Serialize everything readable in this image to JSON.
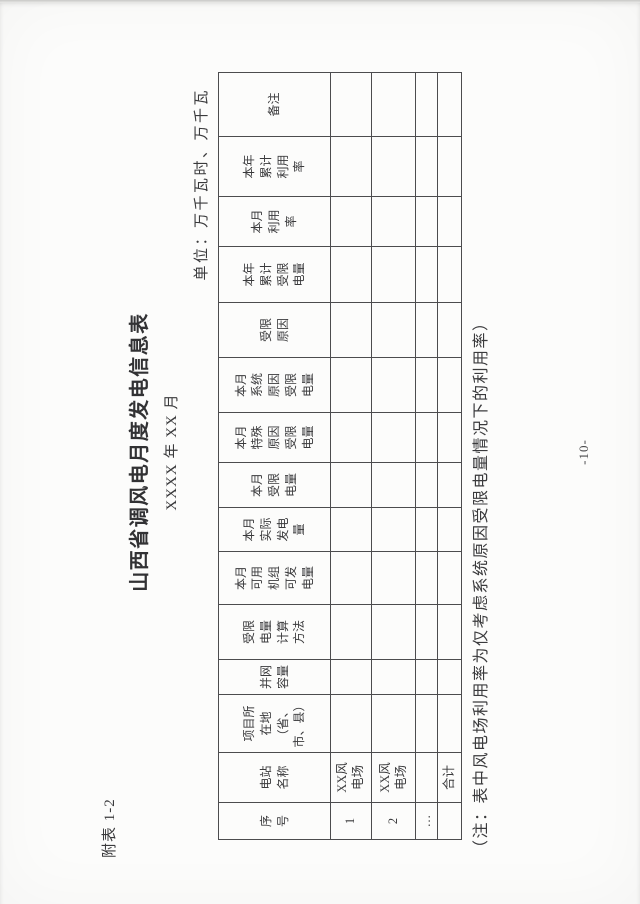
{
  "page": {
    "attachment_label": "附表 1-2",
    "title": "山西省调风电月度发电信息表",
    "subtitle": "XXXX 年 XX 月",
    "unit_label": "单位：万千瓦时、万千瓦",
    "footnote": "（注：表中风电场利用率为仅考虑系统原因受限电量情况下的利用率）",
    "page_number": "-10-"
  },
  "table": {
    "headers": [
      "序\n号",
      "电站\n名称",
      "项目所\n在地\n（省、\n市、县）",
      "并网\n容量",
      "受限\n电量\n计算\n方法",
      "本月\n可用\n机组\n可发\n电量",
      "本月\n实际\n发电\n量",
      "本月\n受限\n电量",
      "本月\n特殊\n原因\n受限\n电量",
      "本月\n系统\n原因\n受限\n电量",
      "受限\n原因",
      "本年\n累计\n受限\n电量",
      "本月\n利用\n率",
      "本年\n累计\n利用\n率",
      "备注"
    ],
    "rows": [
      [
        "1",
        "XX风\n电场",
        "",
        "",
        "",
        "",
        "",
        "",
        "",
        "",
        "",
        "",
        "",
        "",
        ""
      ],
      [
        "2",
        "XX风\n电场",
        "",
        "",
        "",
        "",
        "",
        "",
        "",
        "",
        "",
        "",
        "",
        "",
        ""
      ],
      [
        "…",
        "",
        "",
        "",
        "",
        "",
        "",
        "",
        "",
        "",
        "",
        "",
        "",
        "",
        ""
      ],
      [
        "",
        "合计",
        "",
        "",
        "",
        "",
        "",
        "",
        "",
        "",
        "",
        "",
        "",
        "",
        ""
      ]
    ]
  }
}
